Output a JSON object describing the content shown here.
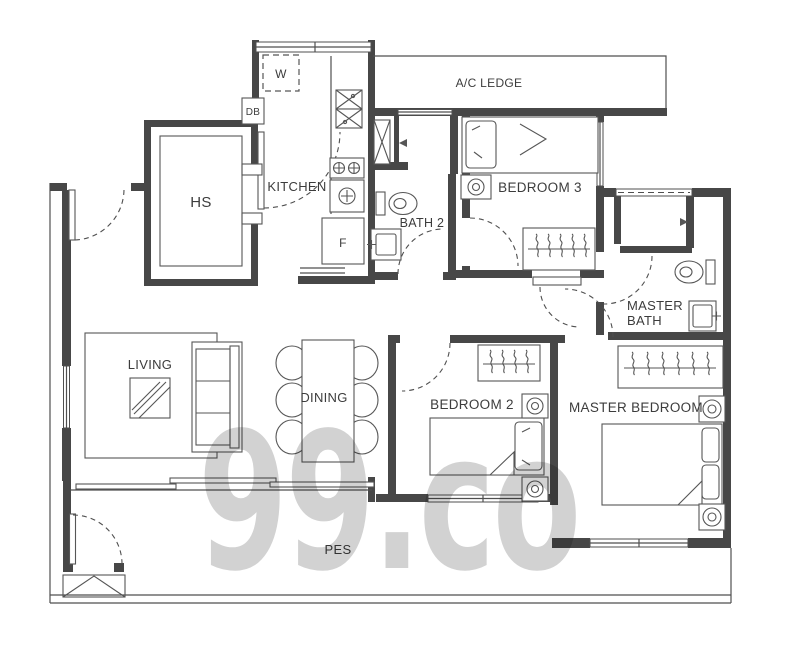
{
  "plan": {
    "watermark": "99.co",
    "labels": {
      "hs": "HS",
      "kitchen": "KITCHEN",
      "washer": "W",
      "db": "DB",
      "fridge": "F",
      "bath2": "BATH 2",
      "ac_ledge": "A/C LEDGE",
      "bedroom3": "BEDROOM 3",
      "master_bath_1": "MASTER",
      "master_bath_2": "BATH",
      "living": "LIVING",
      "dining": "DINING",
      "bedroom2": "BEDROOM 2",
      "master_bedroom": "MASTER BEDROOM",
      "pes": "PES"
    },
    "fixtures": [
      "single-bed",
      "double-bed",
      "pillow",
      "wardrobe-hangers",
      "bedside-table-lamp",
      "toilet",
      "wash-basin",
      "shower-head",
      "kitchen-sink",
      "cooker-hob",
      "fridge",
      "washing-machine",
      "distribution-board",
      "household-shelter",
      "sofa",
      "coffee-table",
      "rug",
      "dining-table",
      "dining-chair",
      "door-swing",
      "sliding-door",
      "window",
      "duct",
      "gate-steps"
    ],
    "colors": {
      "wall": "#474747",
      "line": "#4f4f4f",
      "label": "#3c3c3c",
      "watermark": "#d2d2d2",
      "background": "#ffffff"
    }
  }
}
